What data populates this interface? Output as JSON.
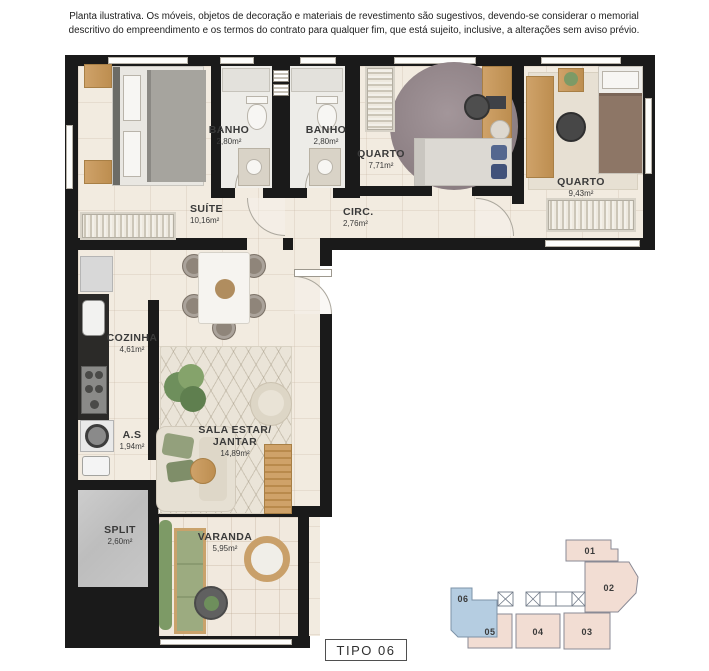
{
  "disclaimer": "Planta ilustrativa. Os móveis, objetos de decoração e materiais de revestimento são sugestivos, devendo-se considerar o memorial descritivo do empreendimento e os termos do contrato para qualquer fim, que está sujeito, inclusive, a alterações sem aviso prévio.",
  "rooms": {
    "suite": {
      "name": "SUÍTE",
      "area": "10,16m²"
    },
    "banho1": {
      "name": "BANHO",
      "area": "2,80m²"
    },
    "banho2": {
      "name": "BANHO",
      "area": "2,80m²"
    },
    "quarto1": {
      "name": "QUARTO",
      "area": "7,71m²"
    },
    "quarto2": {
      "name": "QUARTO",
      "area": "9,43m²"
    },
    "circ": {
      "name": "CIRC.",
      "area": "2,76m²"
    },
    "cozinha": {
      "name": "COZINHA",
      "area": "4,61m²"
    },
    "as": {
      "name": "A.S",
      "area": "1,94m²"
    },
    "sala": {
      "name": "SALA ESTAR/ JANTAR",
      "area": "14,89m²"
    },
    "split": {
      "name": "SPLIT",
      "area": "2,60m²"
    },
    "varanda": {
      "name": "VARANDA",
      "area": "5,95m²"
    }
  },
  "keyplan": {
    "units": [
      {
        "label": "01"
      },
      {
        "label": "02"
      },
      {
        "label": "03"
      },
      {
        "label": "04"
      },
      {
        "label": "05"
      },
      {
        "label": "06"
      }
    ],
    "highlighted_unit": "06"
  },
  "type_label": "TIPO 06",
  "colors": {
    "wall": "#1a1a1a",
    "floor": "#f2ebe0",
    "wood": "#c89a5e",
    "green": "#7d9a66",
    "label": "#3a3a3a",
    "accent-blue": "#b5cde1",
    "unit-pink": "#f2ddd3"
  }
}
